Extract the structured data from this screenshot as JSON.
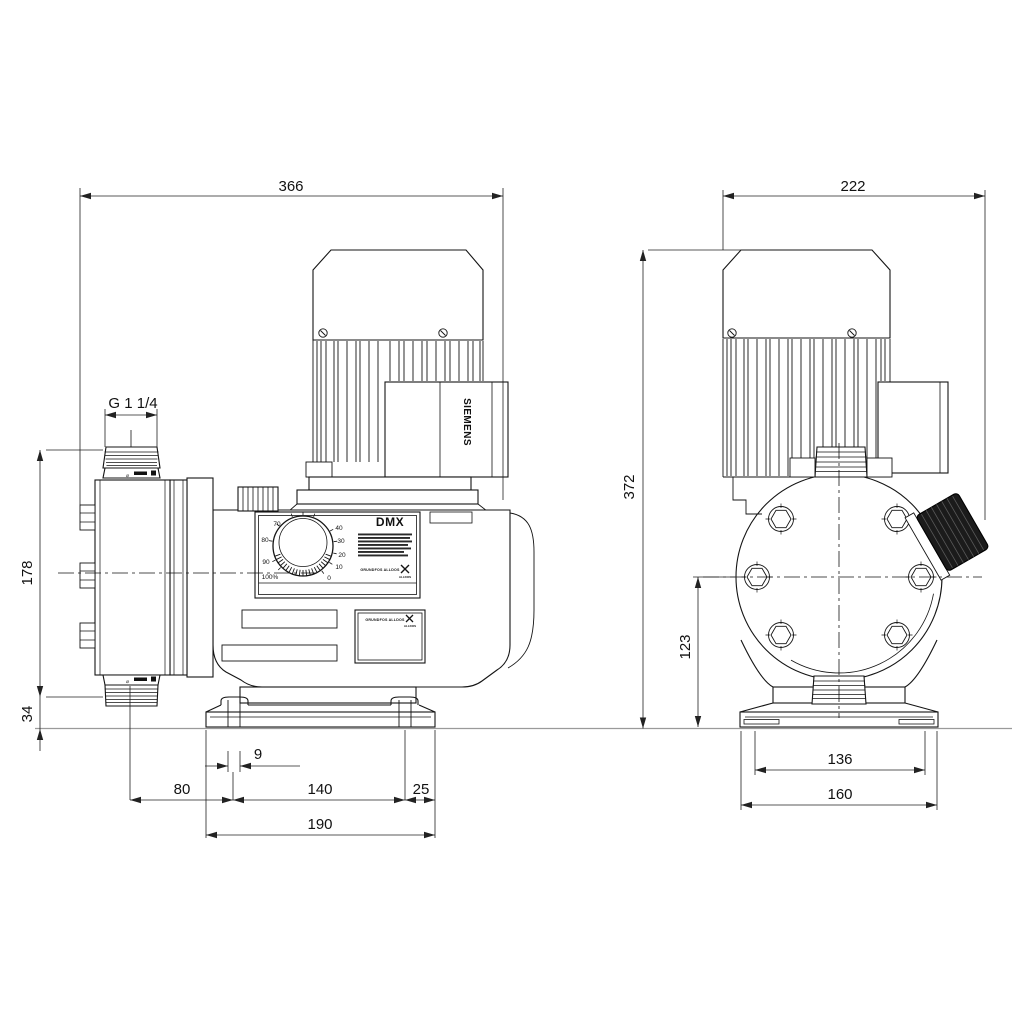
{
  "side_view": {
    "dims": {
      "total_width": "366",
      "connection_thread": "G 1 1/4",
      "head_height": "178",
      "base_height": "34",
      "foot_slot_width": "9",
      "head_to_foot": "80",
      "foot_hole_spacing": "140",
      "foot_edge": "25",
      "foot_width": "190"
    },
    "panel": {
      "model": "DMX",
      "dial_labels": [
        "100%",
        "90",
        "80",
        "70",
        "40",
        "30",
        "20",
        "10",
        "0"
      ],
      "brand": "GRUNDFOS ALLDOS",
      "brand_sub": "ALLDOS"
    },
    "motor_brand": "SIEMENS",
    "port_symbol": "⌀"
  },
  "front_view": {
    "dims": {
      "total_width": "222",
      "total_height": "372",
      "port_center_height": "123",
      "foot_slot_spacing": "136",
      "foot_width": "160"
    }
  }
}
